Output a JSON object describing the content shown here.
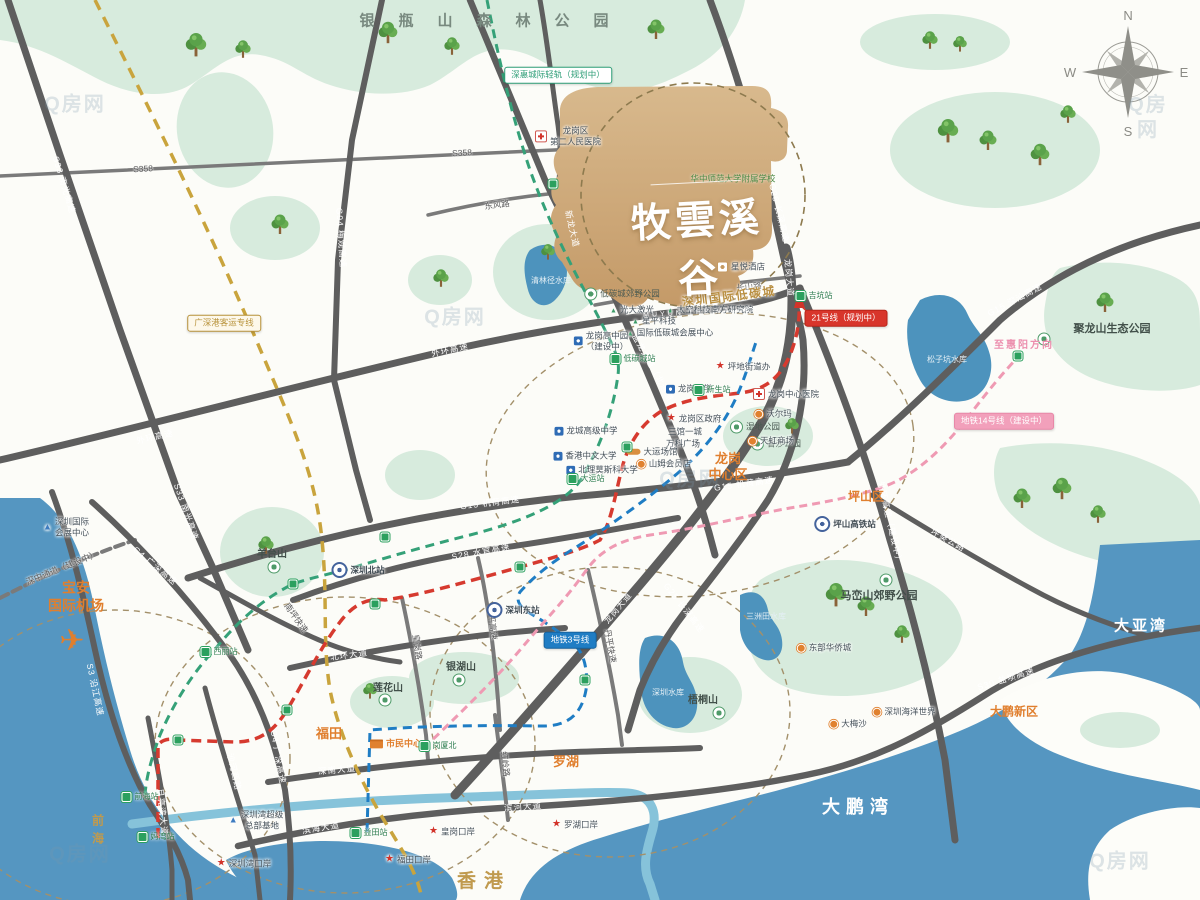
{
  "project": {
    "name_cn": "牧雲溪谷",
    "name_en": "MUYUN THE VALLEY"
  },
  "compass": {
    "n": "N",
    "e": "E",
    "s": "S",
    "w": "W"
  },
  "labels": [
    {
      "n": "forest-park-title",
      "t": "银瓶山森林公园",
      "x": 496,
      "y": 22,
      "c": "forest"
    },
    {
      "n": "airport-label",
      "t": "宝安\n国际机场",
      "x": 76,
      "y": 597,
      "c": "area-lg"
    },
    {
      "n": "airplane-icon",
      "t": "✈",
      "x": 72,
      "y": 641,
      "c": "plane"
    },
    {
      "n": "district-futian",
      "t": "福田",
      "x": 329,
      "y": 734,
      "c": "area"
    },
    {
      "n": "district-luohu",
      "t": "罗湖",
      "x": 566,
      "y": 762,
      "c": "area"
    },
    {
      "n": "district-longgang-center",
      "t": "龙岗\n中心区",
      "x": 728,
      "y": 467,
      "c": "area"
    },
    {
      "n": "district-pingshan",
      "t": "坪山区",
      "x": 866,
      "y": 497,
      "c": "area-sm"
    },
    {
      "n": "district-dapeng",
      "t": "大鹏新区",
      "x": 1014,
      "y": 712,
      "c": "area-sm"
    },
    {
      "n": "civic-center",
      "t": "市民中心",
      "x": 396,
      "y": 744,
      "c": "poi-orange",
      "m": "civic"
    },
    {
      "n": "low-carbon-city-title",
      "t": "深圳国际低碳城",
      "x": 729,
      "y": 297,
      "c": "gold-md",
      "r": -7
    },
    {
      "n": "hongkong",
      "t": "香港",
      "x": 484,
      "y": 882,
      "c": "gold-lg"
    },
    {
      "n": "qianhai",
      "t": "前海",
      "x": 97,
      "y": 832,
      "c": "gold-v"
    },
    {
      "n": "bay-dapeng",
      "t": "大鹏湾",
      "x": 858,
      "y": 807,
      "c": "water-lg"
    },
    {
      "n": "bay-daya",
      "t": "大亚湾",
      "x": 1141,
      "y": 627,
      "c": "water-lg2"
    },
    {
      "n": "reservoir-sanzhoutian",
      "t": "三洲田水库",
      "x": 766,
      "y": 617,
      "c": "water-sm"
    },
    {
      "n": "reservoir-songzikeng",
      "t": "松子坑水库",
      "x": 947,
      "y": 360,
      "c": "water-sm"
    },
    {
      "n": "reservoir-shenzhen",
      "t": "深圳水库",
      "x": 668,
      "y": 693,
      "c": "water-sm"
    },
    {
      "n": "reservoir-qinglinjing",
      "t": "清林径水库",
      "x": 551,
      "y": 281,
      "c": "water-sm"
    },
    {
      "n": "park-julongshan",
      "t": "聚龙山生态公园",
      "x": 1112,
      "y": 330,
      "c": "park-lg"
    },
    {
      "n": "park-julongshan-icon",
      "t": "",
      "x": 1044,
      "y": 339,
      "c": "poi",
      "m": "park"
    },
    {
      "n": "park-maluanshan",
      "t": "马峦山郊野公园",
      "x": 879,
      "y": 597,
      "c": "park-lg"
    },
    {
      "n": "park-maluanshan-icon",
      "t": "",
      "x": 886,
      "y": 580,
      "c": "poi",
      "m": "park"
    },
    {
      "n": "mt-wutong",
      "t": "梧桐山",
      "x": 703,
      "y": 701,
      "c": "park-md"
    },
    {
      "n": "mt-wutong-icon",
      "t": "",
      "x": 719,
      "y": 713,
      "c": "poi",
      "m": "park"
    },
    {
      "n": "mt-yinhu",
      "t": "银湖山",
      "x": 461,
      "y": 668,
      "c": "park-md"
    },
    {
      "n": "mt-yinhu-icon",
      "t": "",
      "x": 459,
      "y": 680,
      "c": "poi",
      "m": "park"
    },
    {
      "n": "mt-lianhua",
      "t": "莲花山",
      "x": 388,
      "y": 689,
      "c": "park-md"
    },
    {
      "n": "mt-lianhua-icon",
      "t": "",
      "x": 385,
      "y": 700,
      "c": "poi",
      "m": "park"
    },
    {
      "n": "mt-yangtai",
      "t": "羊台山",
      "x": 272,
      "y": 555,
      "c": "park-md"
    },
    {
      "n": "mt-yangtai-icon",
      "t": "",
      "x": 274,
      "y": 567,
      "c": "poi",
      "m": "park"
    },
    {
      "n": "park-lowcarbon-country",
      "t": "低碳城郊野公园",
      "x": 622,
      "y": 294,
      "c": "park-sm",
      "m": "park"
    },
    {
      "n": "park-wetland",
      "t": "湿地公园",
      "x": 755,
      "y": 427,
      "c": "park-sm",
      "m": "park"
    },
    {
      "n": "park-xiangsha",
      "t": "香沙公园",
      "x": 776,
      "y": 444,
      "c": "park-sm",
      "m": "park"
    },
    {
      "n": "oct-east",
      "t": "东部华侨城",
      "x": 824,
      "y": 648,
      "c": "poi",
      "m": "dot-orange"
    },
    {
      "n": "road-s33",
      "t": "S33 南光高速",
      "x": 64,
      "y": 185,
      "c": "road",
      "r": 73
    },
    {
      "n": "road-s33-2",
      "t": "S33 南光高速",
      "x": 186,
      "y": 512,
      "c": "road",
      "r": 71
    },
    {
      "n": "road-s3",
      "t": "S3 沿江高速",
      "x": 95,
      "y": 690,
      "c": "road",
      "r": 78
    },
    {
      "n": "road-s358",
      "t": "S358",
      "x": 143,
      "y": 169,
      "c": "road-dark",
      "r": -3
    },
    {
      "n": "road-s358-2",
      "t": "S358",
      "x": 462,
      "y": 153,
      "c": "road-dark",
      "r": -3
    },
    {
      "n": "road-g94",
      "t": "G94 梅观高速",
      "x": 341,
      "y": 238,
      "c": "road",
      "r": 86
    },
    {
      "n": "road-outer-ring",
      "t": "外环高速",
      "x": 155,
      "y": 437,
      "c": "road",
      "r": -13
    },
    {
      "n": "road-outer-ring-2",
      "t": "外环高速",
      "x": 450,
      "y": 350,
      "c": "road",
      "r": -12
    },
    {
      "n": "road-outer-ring-3",
      "t": "外环高速（建设中）",
      "x": 890,
      "y": 523,
      "c": "road",
      "r": 77
    },
    {
      "n": "road-g25",
      "t": "G25 长深高速",
      "x": 779,
      "y": 213,
      "c": "road",
      "r": 76
    },
    {
      "n": "road-g25-2",
      "t": "G25 长深高速",
      "x": 684,
      "y": 608,
      "c": "road",
      "r": 52
    },
    {
      "n": "road-g15-shenshan",
      "t": "G15 深汕高速",
      "x": 1015,
      "y": 300,
      "c": "road",
      "r": -28
    },
    {
      "n": "road-g15-jihe",
      "t": "G15 机荷高速",
      "x": 490,
      "y": 503,
      "c": "road",
      "r": -7
    },
    {
      "n": "road-g15-jihe-2",
      "t": "G15 机荷高速",
      "x": 744,
      "y": 484,
      "c": "road",
      "r": -8
    },
    {
      "n": "road-s28",
      "t": "S28 水官高速",
      "x": 481,
      "y": 552,
      "c": "road",
      "r": -10
    },
    {
      "n": "road-beihuan",
      "t": "北环大道",
      "x": 349,
      "y": 655,
      "c": "road",
      "r": -7
    },
    {
      "n": "road-shennan",
      "t": "深南大道",
      "x": 337,
      "y": 770,
      "c": "road",
      "r": -5
    },
    {
      "n": "road-binhai",
      "t": "滨海大道",
      "x": 321,
      "y": 828,
      "c": "road",
      "r": -9
    },
    {
      "n": "road-binhe",
      "t": "滨河大道",
      "x": 523,
      "y": 807,
      "c": "road",
      "r": -4
    },
    {
      "n": "road-s30",
      "t": "S30 盐坝高速",
      "x": 1006,
      "y": 679,
      "c": "road",
      "r": -17
    },
    {
      "n": "road-longgang-ave",
      "t": "龙岗大道",
      "x": 789,
      "y": 278,
      "c": "road",
      "r": 85
    },
    {
      "n": "road-longgang-ave-2",
      "t": "龙岗大道",
      "x": 618,
      "y": 608,
      "c": "road",
      "r": -50
    },
    {
      "n": "road-yanlong",
      "t": "盐龙大道（北通道）",
      "x": 655,
      "y": 372,
      "c": "road",
      "r": 61
    },
    {
      "n": "road-xinlong",
      "t": "新龙大道",
      "x": 572,
      "y": 229,
      "c": "road",
      "r": 77
    },
    {
      "n": "road-dongfeng",
      "t": "东风路",
      "x": 497,
      "y": 205,
      "c": "road-dark",
      "r": -8
    },
    {
      "n": "road-changshan",
      "t": "长山路",
      "x": 749,
      "y": 287,
      "c": "road-dark",
      "r": -6
    },
    {
      "n": "road-pingkui",
      "t": "坪葵公路",
      "x": 948,
      "y": 540,
      "c": "road",
      "r": 29
    },
    {
      "n": "road-yueliangwan",
      "t": "月亮湾大道",
      "x": 162,
      "y": 812,
      "c": "road",
      "r": 84
    },
    {
      "n": "road-shahexi",
      "t": "沙河西路",
      "x": 234,
      "y": 772,
      "c": "road",
      "r": 77
    },
    {
      "n": "road-qingping",
      "t": "清平高速",
      "x": 492,
      "y": 623,
      "c": "road-dark",
      "r": 84
    },
    {
      "n": "road-danping",
      "t": "丹平快速",
      "x": 610,
      "y": 646,
      "c": "road-dark",
      "r": 80
    },
    {
      "n": "road-hongling",
      "t": "红岭路",
      "x": 505,
      "y": 764,
      "c": "road-dark",
      "r": 84
    },
    {
      "n": "road-huanggang",
      "t": "皇岗路",
      "x": 417,
      "y": 647,
      "c": "road-dark",
      "r": 82
    },
    {
      "n": "road-nanping",
      "t": "南坪快速",
      "x": 296,
      "y": 618,
      "c": "road-dark",
      "r": 55
    },
    {
      "n": "road-g4",
      "t": "G4 广深高速",
      "x": 155,
      "y": 566,
      "c": "road",
      "r": 40
    },
    {
      "n": "road-g4-2",
      "t": "G4 广深高速",
      "x": 278,
      "y": 757,
      "c": "road",
      "r": 80
    },
    {
      "n": "road-shenzhong",
      "t": "深中通道（建设中）",
      "x": 62,
      "y": 568,
      "c": "road-dark",
      "r": -22
    },
    {
      "n": "badge-shenhui-rail",
      "t": "深惠城际轻轨（规划中）",
      "x": 558,
      "y": 75,
      "c": "badge-green"
    },
    {
      "n": "badge-gsg-rail",
      "t": "广深港客运专线",
      "x": 224,
      "y": 323,
      "c": "badge-gold"
    },
    {
      "n": "badge-line21",
      "t": "21号线（规划中）",
      "x": 846,
      "y": 318,
      "c": "badge-red"
    },
    {
      "n": "badge-line3",
      "t": "地铁3号线",
      "x": 570,
      "y": 640,
      "c": "badge-blue"
    },
    {
      "n": "badge-line14",
      "t": "地铁14号线（建设中）",
      "x": 1004,
      "y": 421,
      "c": "badge-pink"
    },
    {
      "n": "to-huiyang",
      "t": "至惠阳方向",
      "x": 1024,
      "y": 346,
      "c": "pink-text"
    },
    {
      "n": "school-hzsd",
      "t": "华中师范大学附属学校",
      "x": 733,
      "y": 179,
      "c": "poi-green"
    },
    {
      "n": "hotel-xingyue",
      "t": "星悦酒店",
      "x": 741,
      "y": 267,
      "c": "poi",
      "m": "hotel"
    },
    {
      "n": "hospital-no2",
      "t": "龙岗区\n第二人民医院",
      "x": 568,
      "y": 136,
      "c": "poi",
      "m": "cross"
    },
    {
      "n": "poi-gd-laser",
      "t": "光大激光",
      "x": 632,
      "y": 310,
      "c": "poi",
      "m": "tri-green"
    },
    {
      "n": "poi-space-tech",
      "t": "太空科技南方研究院",
      "x": 710,
      "y": 310,
      "c": "poi",
      "m": "tri-green"
    },
    {
      "n": "poi-xingping",
      "t": "星平科技",
      "x": 654,
      "y": 321,
      "c": "poi",
      "m": "tri-green"
    },
    {
      "n": "poi-lcc-expo",
      "t": "国际低碳城会展中心",
      "x": 670,
      "y": 333,
      "c": "poi",
      "m": "tri-green"
    },
    {
      "n": "poi-gaozhongyuan",
      "t": "龙岗高中园\n（建设中）",
      "x": 601,
      "y": 341,
      "c": "poi",
      "m": "school"
    },
    {
      "n": "poi-pingdi-office",
      "t": "坪地街道办",
      "x": 743,
      "y": 367,
      "c": "poi",
      "m": "star-red"
    },
    {
      "n": "poi-walmart",
      "t": "沃尔玛",
      "x": 773,
      "y": 414,
      "c": "poi",
      "m": "dot-orange"
    },
    {
      "n": "poi-rainbow",
      "t": "天虹商场",
      "x": 771,
      "y": 441,
      "c": "poi",
      "m": "dot-orange"
    },
    {
      "n": "hospital-lg-center",
      "t": "龙岗中心医院",
      "x": 786,
      "y": 394,
      "c": "poi",
      "m": "cross"
    },
    {
      "n": "school-lg-middle",
      "t": "龙岗中学",
      "x": 689,
      "y": 389,
      "c": "poi",
      "m": "school"
    },
    {
      "n": "poi-lg-gov",
      "t": "龙岗区政府",
      "x": 694,
      "y": 419,
      "c": "poi",
      "m": "star-red"
    },
    {
      "n": "poi-sanguan",
      "t": "三馆一城",
      "x": 685,
      "y": 432,
      "c": "poi"
    },
    {
      "n": "poi-vanke-plaza",
      "t": "万科广场",
      "x": 683,
      "y": 444,
      "c": "poi"
    },
    {
      "n": "poi-dayun-stadium",
      "t": "大运场馆",
      "x": 652,
      "y": 452,
      "c": "poi",
      "m": "stadium"
    },
    {
      "n": "poi-sams",
      "t": "山姆会员店",
      "x": 664,
      "y": 464,
      "c": "poi",
      "m": "dot-orange"
    },
    {
      "n": "school-longcheng",
      "t": "龙城高级中学",
      "x": 586,
      "y": 431,
      "c": "poi",
      "m": "school"
    },
    {
      "n": "school-cuhk",
      "t": "香港中文大学",
      "x": 585,
      "y": 456,
      "c": "poi",
      "m": "school"
    },
    {
      "n": "school-msu",
      "t": "北理莫斯科大学",
      "x": 602,
      "y": 470,
      "c": "poi",
      "m": "school"
    },
    {
      "n": "poi-expo-center",
      "t": "深圳国际\n会展中心",
      "x": 66,
      "y": 527,
      "c": "poi",
      "m": "tri-blue"
    },
    {
      "n": "poi-bay-hq",
      "t": "深圳湾超级\n总部基地",
      "x": 256,
      "y": 820,
      "c": "poi",
      "m": "tri-blue"
    },
    {
      "n": "poi-sea-world",
      "t": "深圳海洋世界",
      "x": 904,
      "y": 712,
      "c": "poi",
      "m": "dot-orange"
    },
    {
      "n": "poi-dameisha",
      "t": "大梅沙",
      "x": 848,
      "y": 724,
      "c": "poi",
      "m": "dot-orange"
    },
    {
      "n": "port-shenzhenwan",
      "t": "深圳湾口岸",
      "x": 244,
      "y": 864,
      "c": "poi",
      "m": "star-red"
    },
    {
      "n": "port-futian",
      "t": "福田口岸",
      "x": 408,
      "y": 860,
      "c": "poi",
      "m": "star-red"
    },
    {
      "n": "port-huanggang",
      "t": "皇岗口岸",
      "x": 452,
      "y": 832,
      "c": "poi",
      "m": "star-red"
    },
    {
      "n": "port-luohu",
      "t": "罗湖口岸",
      "x": 575,
      "y": 825,
      "c": "poi",
      "m": "star-red"
    },
    {
      "n": "station-jikeng",
      "t": "吉坑站",
      "x": 814,
      "y": 296,
      "c": "sta",
      "m": "sta-green"
    },
    {
      "n": "station-ditancheng",
      "t": "低碳城站",
      "x": 633,
      "y": 359,
      "c": "sta",
      "m": "sta-green"
    },
    {
      "n": "station-dayun",
      "t": "大运站",
      "x": 586,
      "y": 479,
      "c": "sta",
      "m": "sta-green"
    },
    {
      "n": "station-xili",
      "t": "西丽站",
      "x": 219,
      "y": 652,
      "c": "sta",
      "m": "sta-green"
    },
    {
      "n": "station-qianhai",
      "t": "前海站",
      "x": 140,
      "y": 797,
      "c": "sta",
      "m": "sta-green"
    },
    {
      "n": "station-mawan",
      "t": "妈湾站",
      "x": 156,
      "y": 837,
      "c": "sta",
      "m": "sta-green"
    },
    {
      "n": "station-yitian",
      "t": "益田站",
      "x": 369,
      "y": 833,
      "c": "sta",
      "m": "sta-green"
    },
    {
      "n": "station-gangxiabei",
      "t": "岗厦北",
      "x": 438,
      "y": 746,
      "c": "sta",
      "m": "sta-green"
    },
    {
      "n": "station-xinsheng",
      "t": "新生站",
      "x": 712,
      "y": 390,
      "c": "sta",
      "m": "sta-green"
    },
    {
      "n": "station-sz-north",
      "t": "深圳北站",
      "x": 358,
      "y": 570,
      "c": "sta-rail",
      "m": "rail"
    },
    {
      "n": "station-sz-east",
      "t": "深圳东站",
      "x": 513,
      "y": 610,
      "c": "sta-rail",
      "m": "rail"
    },
    {
      "n": "station-pingshan-hsr",
      "t": "坪山高铁站",
      "x": 845,
      "y": 524,
      "c": "sta-rail",
      "m": "rail"
    },
    {
      "n": "line-station-dot",
      "t": "",
      "x": 178,
      "y": 740,
      "c": "sta",
      "m": "dot-line"
    },
    {
      "n": "line-station-dot",
      "t": "",
      "x": 287,
      "y": 710,
      "c": "sta",
      "m": "dot-line"
    },
    {
      "n": "line-station-dot",
      "t": "",
      "x": 375,
      "y": 604,
      "c": "sta",
      "m": "dot-line"
    },
    {
      "n": "line-station-dot",
      "t": "",
      "x": 520,
      "y": 567,
      "c": "sta",
      "m": "dot-line"
    },
    {
      "n": "line-station-dot",
      "t": "",
      "x": 627,
      "y": 447,
      "c": "sta",
      "m": "dot-line"
    },
    {
      "n": "line-station-dot",
      "t": "",
      "x": 553,
      "y": 184,
      "c": "sta",
      "m": "dot-line"
    },
    {
      "n": "line-station-dot",
      "t": "",
      "x": 385,
      "y": 537,
      "c": "sta",
      "m": "dot-line"
    },
    {
      "n": "line-station-dot",
      "t": "",
      "x": 293,
      "y": 584,
      "c": "sta",
      "m": "dot-line"
    },
    {
      "n": "line-station-dot",
      "t": "",
      "x": 1018,
      "y": 356,
      "c": "sta",
      "m": "dot-line"
    },
    {
      "n": "line-station-dot",
      "t": "",
      "x": 585,
      "y": 680,
      "c": "sta",
      "m": "dot-line"
    },
    {
      "n": "watermark",
      "t": "Q房网",
      "x": 75,
      "y": 105,
      "c": "wm"
    },
    {
      "n": "watermark",
      "t": "Q房网",
      "x": 1148,
      "y": 118,
      "c": "wm"
    },
    {
      "n": "watermark",
      "t": "Q房网",
      "x": 455,
      "y": 318,
      "c": "wm"
    },
    {
      "n": "watermark",
      "t": "Q房网",
      "x": 690,
      "y": 480,
      "c": "wm"
    },
    {
      "n": "watermark",
      "t": "Q房网",
      "x": 80,
      "y": 855,
      "c": "wm"
    },
    {
      "n": "watermark",
      "t": "Q房网",
      "x": 1120,
      "y": 862,
      "c": "wm"
    }
  ]
}
